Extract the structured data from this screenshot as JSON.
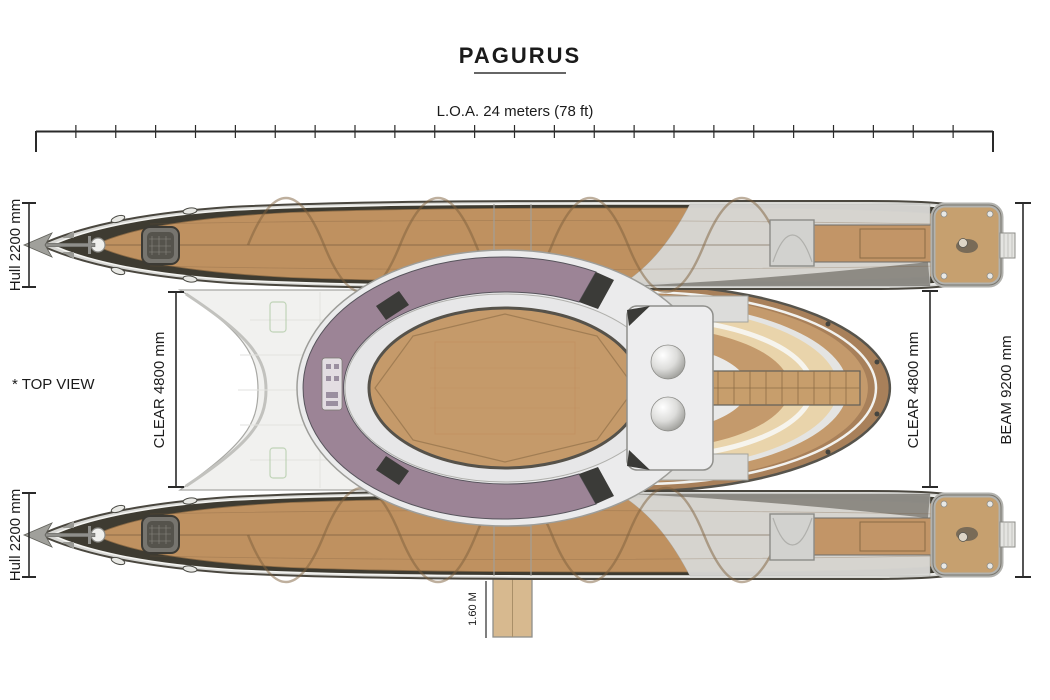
{
  "page": {
    "title": "PAGURUS",
    "view_label": "* TOP VIEW"
  },
  "dimensions": {
    "loa": {
      "label": "L.O.A. 24 meters (78 ft)",
      "ticks": 24
    },
    "hull_top": {
      "label": "Hull 2200 mm"
    },
    "hull_bottom": {
      "label": "Hull 2200 mm"
    },
    "clear_port": {
      "label": "CLEAR 4800 mm"
    },
    "clear_starboard": {
      "label": "CLEAR 4800 mm"
    },
    "beam": {
      "label": "BEAM 9200 mm"
    },
    "gangway": {
      "label": "1.60 M"
    }
  },
  "colors": {
    "deck_wood": "#bf9160",
    "panel_beige": "#e9d4ab",
    "oval_wood": "#c59a6a",
    "dark_sheer": "#3e3b31",
    "cabin_purple": "#9c8496",
    "structure_gray": "#ededee",
    "dim_line": "#2a2a2a"
  }
}
